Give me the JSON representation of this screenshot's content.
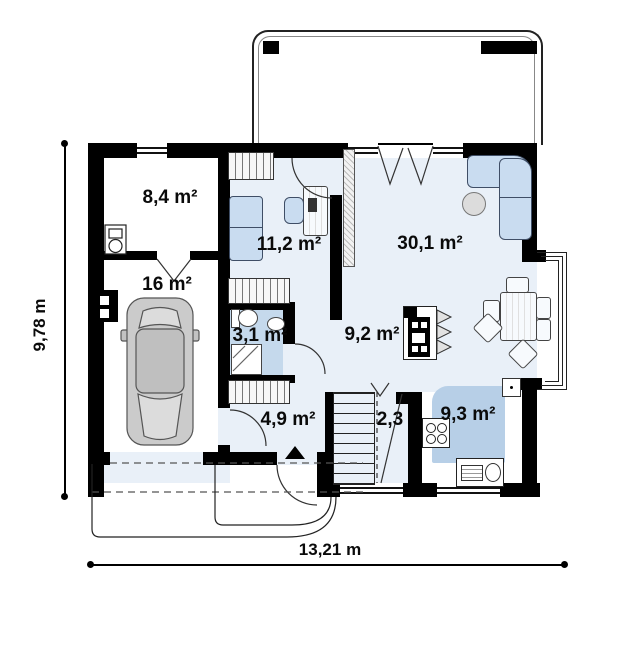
{
  "plan": {
    "rooms": [
      {
        "key": "utility",
        "label": "8,4 m²"
      },
      {
        "key": "garage",
        "label": "16 m²"
      },
      {
        "key": "cabinet",
        "label": "11,2 m²"
      },
      {
        "key": "living_room",
        "label": "30,1 m²"
      },
      {
        "key": "bathroom",
        "label": "3,1 m²"
      },
      {
        "key": "hall",
        "label": "9,2 m²"
      },
      {
        "key": "entry",
        "label": "4,9 m²"
      },
      {
        "key": "corridor",
        "label": "2,3"
      },
      {
        "key": "kitchen",
        "label": "9,3 m²"
      }
    ],
    "dimensions": {
      "height": "9,78 m",
      "width": "13,21 m"
    },
    "colors": {
      "wall": "#000000",
      "room_fill": "#e9f0f8",
      "bathroom_fill": "#c5d9ec",
      "kitchen_fill": "#b7cfe7",
      "furniture_fill": "#c9dcf0",
      "car_fill": "#cbcbcb"
    },
    "icons": [
      "car-icon",
      "sofa-icon",
      "corner-sofa-icon",
      "office-chair-icon",
      "desk-icon",
      "wardrobe-icon",
      "toilet-icon",
      "washbasin-icon",
      "shower-icon",
      "stove-icon",
      "oven-sink-counter-icon",
      "fireplace-icon",
      "dining-table-icon",
      "chair-icon",
      "ottoman-icon",
      "boiler-icon",
      "electrical-panel-icon",
      "stairs-icon",
      "entrance-arrow-icon",
      "sliding-door-icon",
      "radiator-icon"
    ]
  }
}
